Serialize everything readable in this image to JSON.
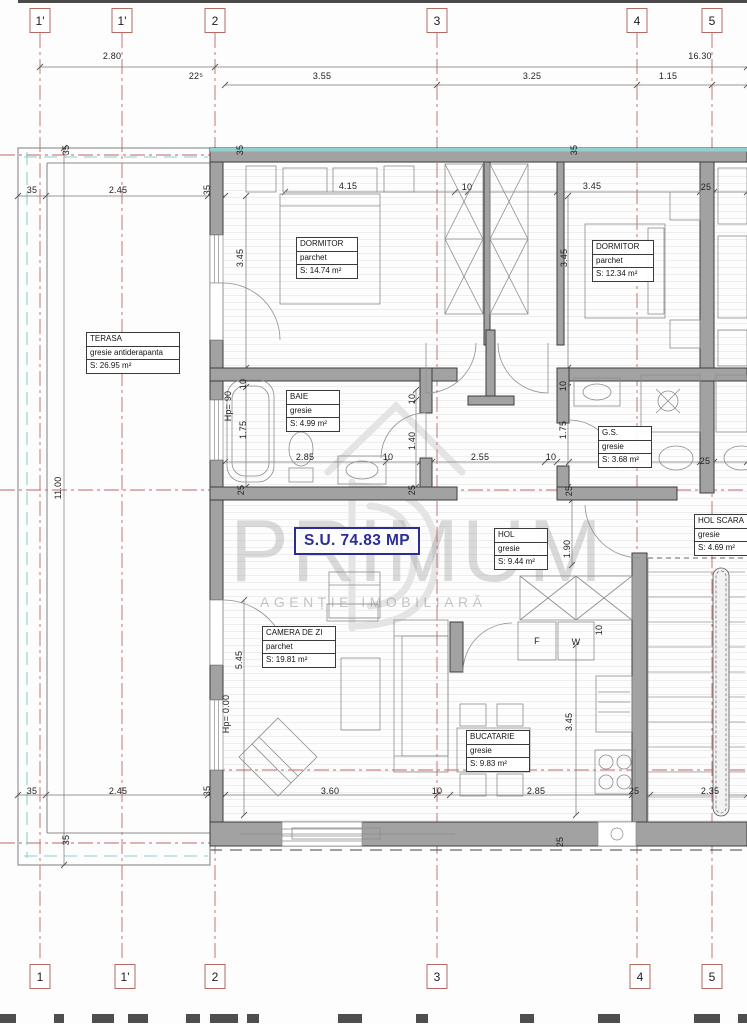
{
  "axes": {
    "top": [
      "1'",
      "1'",
      "2",
      "3",
      "4",
      "5"
    ],
    "bottom": [
      "1",
      "1'",
      "2",
      "3",
      "4",
      "5"
    ]
  },
  "dims": [
    "2.80",
    "16.30",
    "22⁵",
    "3.55",
    "3.25",
    "1.15",
    "35",
    "2.45",
    "35",
    "35",
    "11.00",
    "35",
    "35",
    "4.15",
    "3.45",
    "10",
    "35",
    "3.45",
    "25",
    "3.45",
    "10",
    "Hp= 90",
    "1.75",
    "2.85",
    "10",
    "10",
    "1.40",
    "25",
    "25",
    "2.55",
    "10",
    "10",
    "1.75",
    "2.10",
    "25",
    "25",
    "1.90",
    "10",
    "5.45",
    "Hp= 0.00",
    "3.60",
    "10",
    "35",
    "2.45",
    "35",
    "2.85",
    "25",
    "2.35",
    "3.45",
    "F",
    "W",
    "25"
  ],
  "rooms": {
    "terasa": {
      "name": "TERASA",
      "finish": "gresie antiderapanta",
      "area": "S: 26.95 m²"
    },
    "dormitor1": {
      "name": "DORMITOR",
      "finish": "parchet",
      "area": "S: 14.74 m²"
    },
    "dormitor2": {
      "name": "DORMITOR",
      "finish": "parchet",
      "area": "S: 12.34 m²"
    },
    "baie": {
      "name": "BAIE",
      "finish": "gresie",
      "area": "S: 4.99 m²"
    },
    "gs": {
      "name": "G.S.",
      "finish": "gresie",
      "area": "S: 3.68 m²"
    },
    "hol": {
      "name": "HOL",
      "finish": "gresie",
      "area": "S: 9.44 m²"
    },
    "hol_scara": {
      "name": "HOL SCARA",
      "finish": "gresie",
      "area": "S: 4.69 m²"
    },
    "camera_de_zi": {
      "name": "CAMERA DE ZI",
      "finish": "parchet",
      "area": "S: 19.81 m²"
    },
    "bucatarie": {
      "name": "BUCATARIE",
      "finish": "gresie",
      "area": "S: 9.83 m²"
    }
  },
  "total": {
    "usable_area_label": "S.U. 74.83 MP"
  },
  "watermark": {
    "title": "PRIMUM",
    "subtitle": "AGENȚIE IMOBILIARĂ"
  },
  "colors": {
    "axis_line": "#c06767",
    "wall": "#a2a2a2",
    "insulation": "#93cfcf",
    "total_label": "#2c2c96",
    "watermark": "#bdbdbd"
  }
}
